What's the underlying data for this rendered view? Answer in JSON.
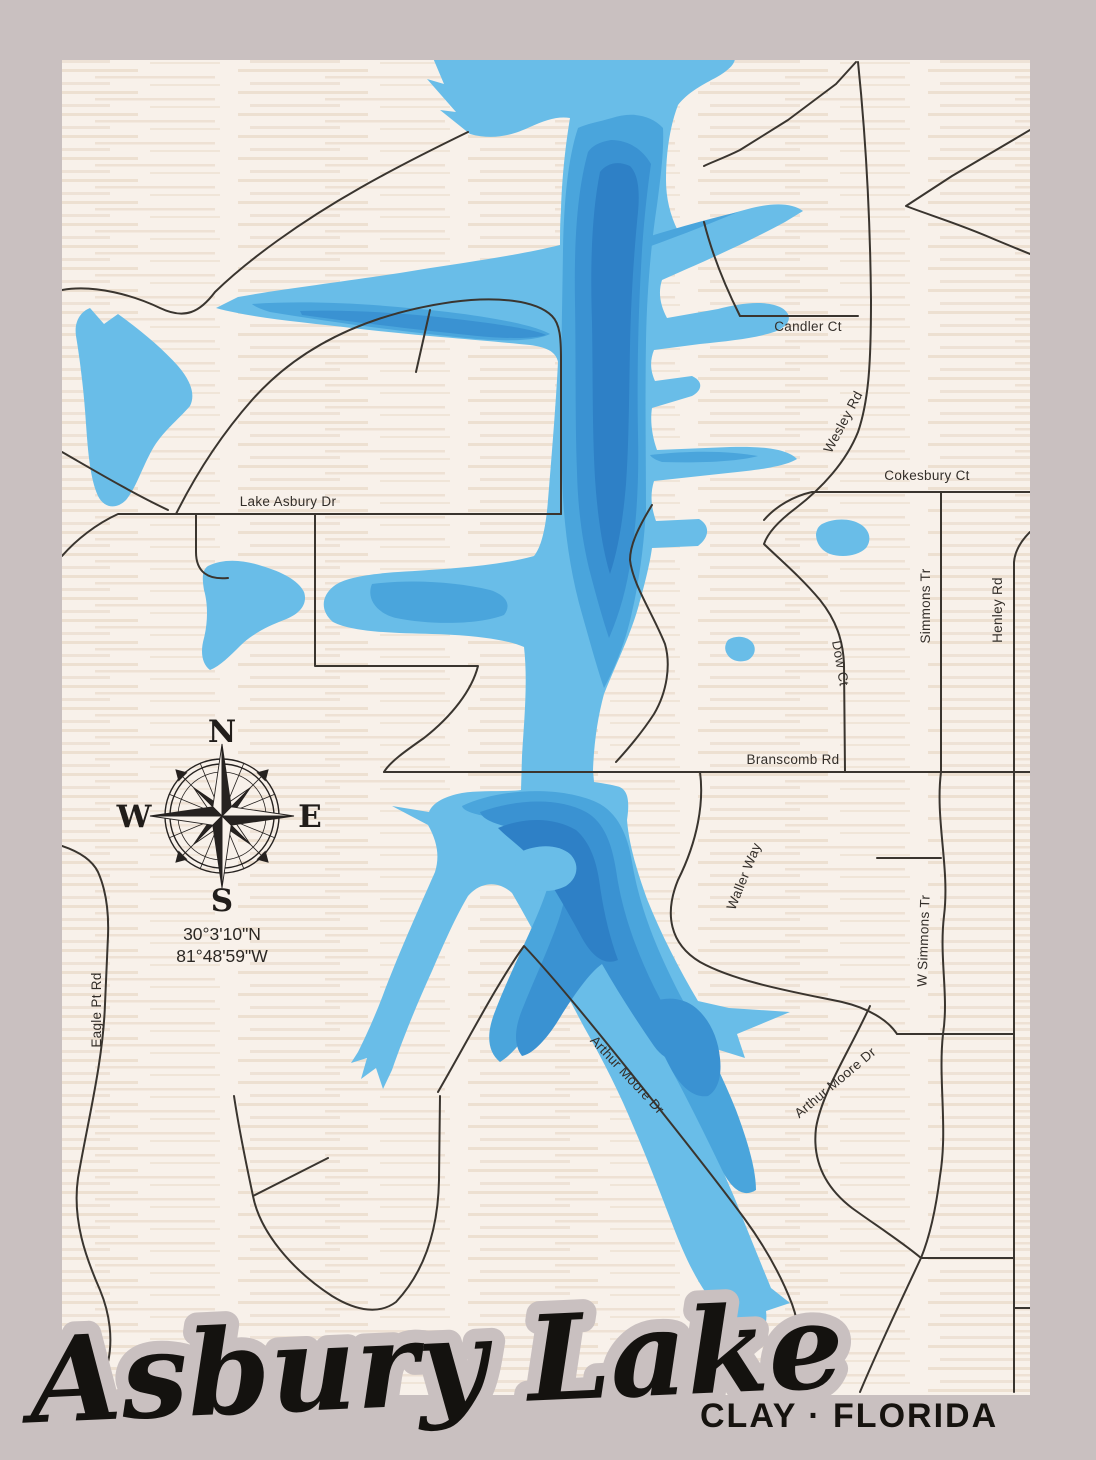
{
  "frame_color": "#c9c0c0",
  "paper_color": "#f8f1ea",
  "road_color": "#3a352f",
  "title": {
    "text": "Asbury Lake",
    "subtitle": "CLAY · FLORIDA"
  },
  "compass": {
    "n": "N",
    "e": "E",
    "s": "S",
    "w": "W"
  },
  "coordinates": {
    "latitude": "30°3'10\"N",
    "longitude": "81°48'59\"W"
  },
  "lake": {
    "name": "Asbury Lake",
    "colors": {
      "shallow": "#69bde8",
      "mid": "#4aa5dc",
      "deep": "#3a92d2",
      "deepest": "#2e80c6"
    }
  },
  "roads": [
    {
      "name": "Candler Ct"
    },
    {
      "name": "Wesley Rd"
    },
    {
      "name": "Cokesbury Ct"
    },
    {
      "name": "Lake Asbury Dr"
    },
    {
      "name": "Dow Ct"
    },
    {
      "name": "Simmons Tr"
    },
    {
      "name": "Henley Rd"
    },
    {
      "name": "Branscomb Rd"
    },
    {
      "name": "Waller Way"
    },
    {
      "name": "W Simmons Tr"
    },
    {
      "name": "Eagle Pt Rd"
    },
    {
      "name": "Arthur Moore Dr"
    },
    {
      "name": "Arthur Moore Dr"
    }
  ]
}
